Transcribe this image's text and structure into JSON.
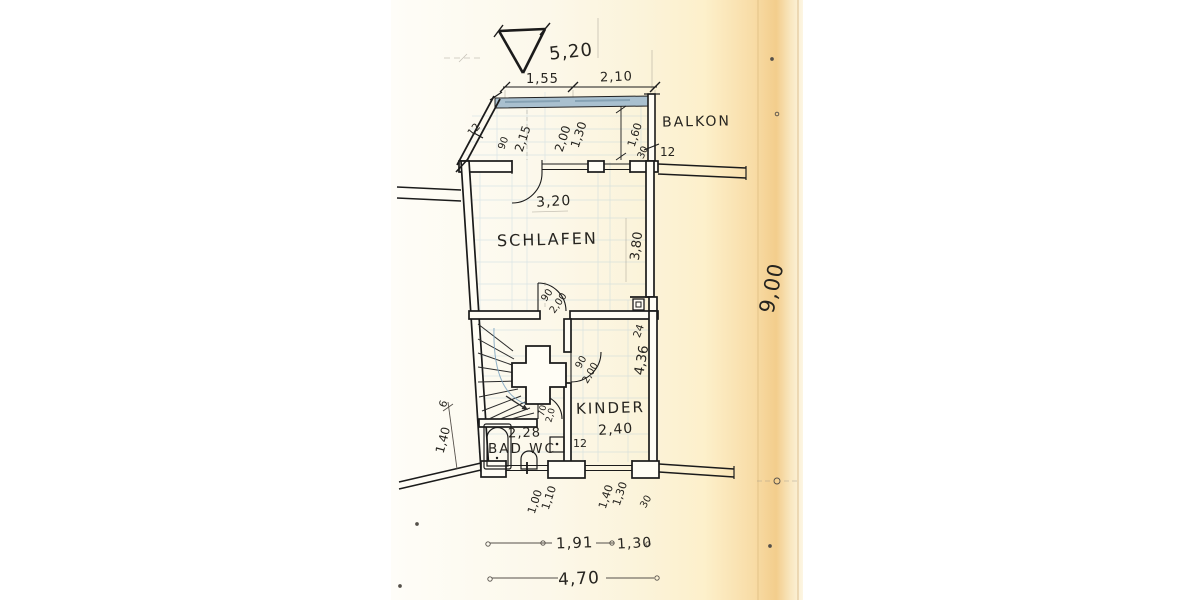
{
  "plan": {
    "labels": {
      "room_schlafen": "SCHLAFEN",
      "room_kinder": "KINDER",
      "room_bad": "BAD WC",
      "room_balkon": "BALKON"
    },
    "dims": {
      "top_overall": "5,20",
      "top_seg_1": "1,55",
      "top_seg_2": "2,10",
      "balcony_rail_thickness": "12",
      "balcony_wall_thickness": "12",
      "balcony_door_width": "90",
      "balcony_door_height": "2,15",
      "balcony_window_width": "2,00",
      "balcony_window_height": "1,30",
      "balcony_depth": "1,60",
      "balcony_edge": "30",
      "schlafen_width": "3,20",
      "schlafen_depth": "3,80",
      "wall_step": "24",
      "kinder_depth": "4,36",
      "schlafen_door_width": "90",
      "schlafen_door_height": "2,00",
      "kinder_door_width": "90",
      "kinder_door_height": "2,00",
      "bad_door_width": "70",
      "bad_door_height": "2,0",
      "bad_width": "2,28",
      "kinder_width": "2,40",
      "bad_wall_thickness": "12",
      "bad_window_width": "1,00",
      "bad_window_height": "1,10",
      "kinder_window_width": "1,40",
      "kinder_window_height": "1,30",
      "bottom_pier": "30",
      "bottom_seg_1": "1,91",
      "bottom_seg_2": "1,30",
      "bottom_overall": "4,70",
      "right_overall": "9,00",
      "left_tick": "6",
      "left_seg": "1,40"
    },
    "colors": {
      "ink": "#1b1b1b",
      "paper_tint": "#fbf3d9",
      "paper_edge": "#f3cd8c",
      "blueprint_line": "#8fb8d4",
      "railing_fill": "#a9c0cf"
    }
  }
}
